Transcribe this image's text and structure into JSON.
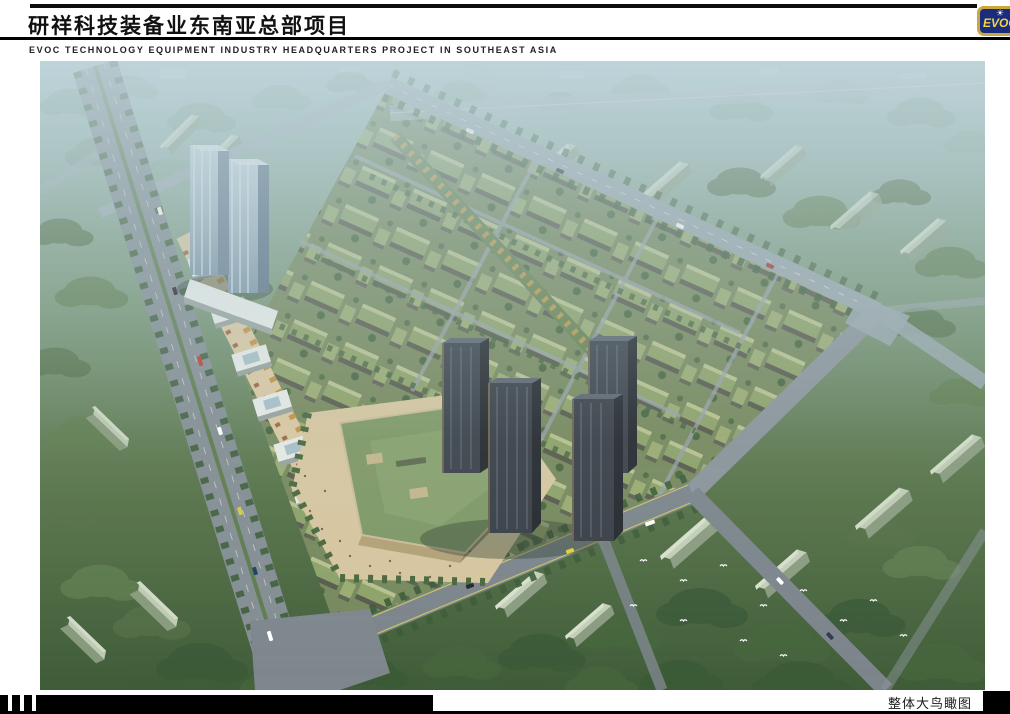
{
  "header": {
    "title": "研祥科技装备业东南亚总部项目",
    "subtitle": "EVOC TECHNOLOGY EQUIPMENT INDUSTRY HEADQUARTERS PROJECT IN SOUTHEAST ASIA"
  },
  "logo": {
    "brand": "EVOC",
    "sun_glyph": "☀",
    "colors": {
      "background": "#1c2c7c",
      "border": "#c9a83f",
      "text": "#f2d53e"
    }
  },
  "footer": {
    "caption": "整体大鸟瞰图"
  }
}
